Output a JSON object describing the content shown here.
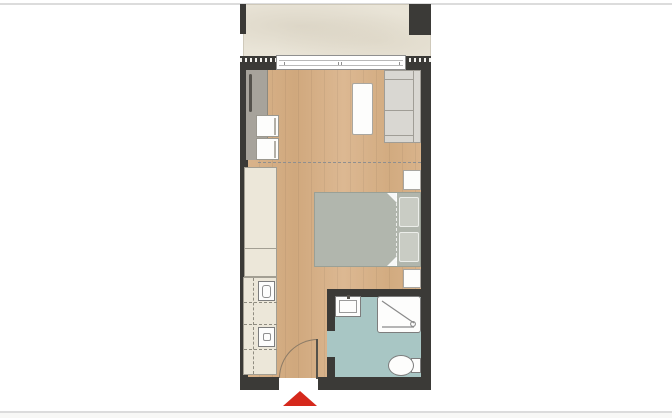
{
  "page": {
    "background": "#ffffff"
  },
  "colors": {
    "page_bg": "#ffffff",
    "page_line": "#dcdcdc",
    "wall": "#3b3a37",
    "wood": "#d6b189",
    "wood_grain": "rgba(0,0,0,0.05)",
    "balcony": "#e9e4d7",
    "bath_floor": "#a8c6c4",
    "cream": "#ece7d9",
    "cream_dark": "#a39f93",
    "sofa": "#d9d7d2",
    "bed": "#b1b6ad",
    "pillow": "#c9ccc4",
    "desk": "#a7a39b",
    "white": "#fdfdfc",
    "red": "#d5281c",
    "dash": "#8f8f8f",
    "fixture_border": "#7d7d7d"
  },
  "rooms": [
    {
      "name": "balcony",
      "floor_color": "#e9e4d7"
    },
    {
      "name": "living-sleeping-area",
      "floor_color": "#d6b189"
    },
    {
      "name": "kitchenette",
      "floor_color": "#ece7d9"
    },
    {
      "name": "bathroom",
      "floor_color": "#a8c6c4"
    }
  ],
  "furniture": [
    "desk",
    "desk-chair",
    "desk-chair",
    "wardrobe",
    "kitchen-sink",
    "cooktop",
    "coffee-table",
    "sofa",
    "double-bed",
    "pillow",
    "pillow",
    "nightstand",
    "nightstand",
    "washbasin",
    "shower",
    "toilet"
  ],
  "openings": [
    "balcony-sliding-door",
    "entry-door",
    "bathroom-door"
  ],
  "markers": [
    "entrance-arrow"
  ]
}
